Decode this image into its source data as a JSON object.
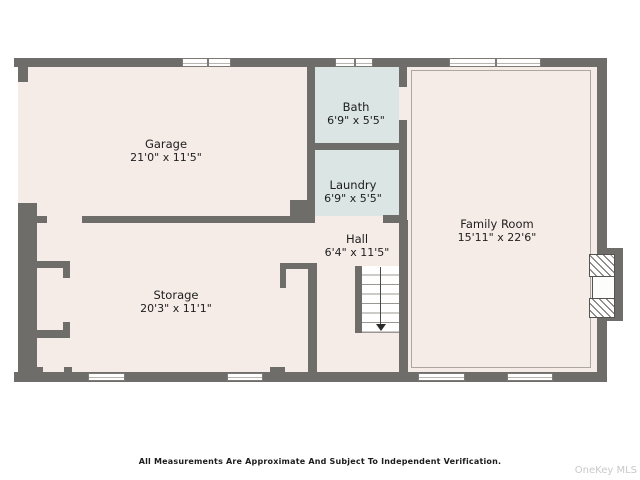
{
  "plan": {
    "rooms": [
      {
        "name": "Garage",
        "dims": "21'0\" x 11'5\""
      },
      {
        "name": "Bath",
        "dims": "6'9\" x 5'5\""
      },
      {
        "name": "Laundry",
        "dims": "6'9\" x 5'5\""
      },
      {
        "name": "Hall",
        "dims": "6'4\" x 11'5\""
      },
      {
        "name": "Family Room",
        "dims": "15'11\" x 22'6\""
      },
      {
        "name": "Storage",
        "dims": "20'3\" x 11'1\""
      }
    ],
    "footer": {
      "disclaimer": "All Measurements Are Approximate And Subject To Independent Verification."
    },
    "watermark": "OneKey MLS",
    "colors": {
      "wall": "#6f6d6a",
      "floor": "#f6ece7",
      "wet_room": "#dbe5e4",
      "background": "#ffffff"
    }
  }
}
